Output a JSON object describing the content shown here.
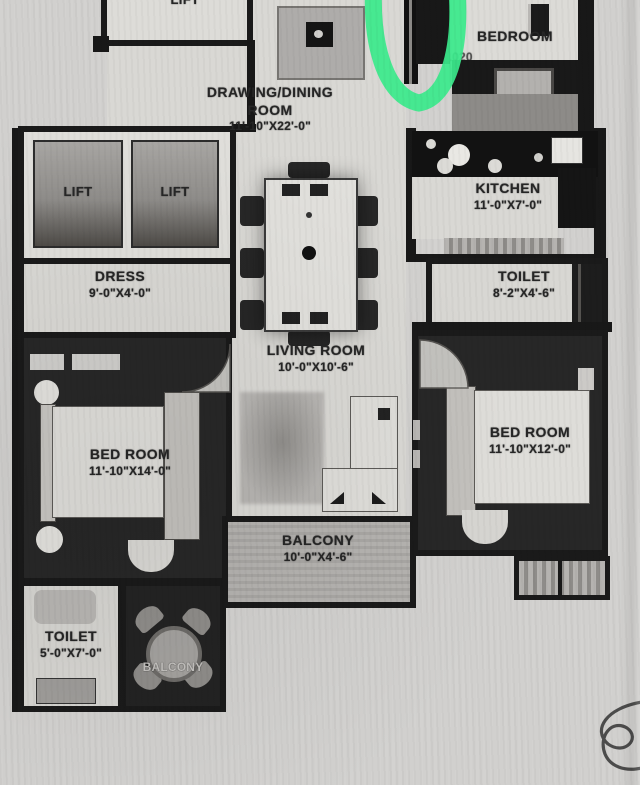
{
  "document": {
    "kind": "Scanned apartment floor plan (black & white photocopy)"
  },
  "rooms": {
    "lift_top": {
      "name": "LIFT"
    },
    "bedroom_top": {
      "name": "BEDROOM",
      "dims": "1020"
    },
    "drawing_dining": {
      "line1": "DRAWING/DINING",
      "line2": "ROOM",
      "dims": "11'-10\"X22'-0\""
    },
    "lift_a": {
      "name": "LIFT"
    },
    "lift_b": {
      "name": "LIFT"
    },
    "kitchen": {
      "name": "KITCHEN",
      "dims": "11'-0\"X7'-0\""
    },
    "dress": {
      "name": "DRESS",
      "dims": "9'-0\"X4'-0\""
    },
    "toilet_right": {
      "name": "TOILET",
      "dims": "8'-2\"X4'-6\""
    },
    "living": {
      "name": "LIVING ROOM",
      "dims": "10'-0\"X10'-6\""
    },
    "bedroom_left": {
      "name": "BED ROOM",
      "dims": "11'-10\"X14'-0\""
    },
    "bedroom_right": {
      "name": "BED ROOM",
      "dims": "11'-10\"X12'-0\""
    },
    "balcony_center": {
      "name": "BALCONY",
      "dims": "10'-0\"X4'-6\""
    },
    "toilet_left": {
      "name": "TOILET",
      "dims": "5'-0\"X7'-0\""
    },
    "balcony_bottom": {
      "name": "BALCONY"
    }
  },
  "annotations": {
    "marker_color": "#3be98c",
    "marker_shape": "green oval highlighter stroke (cut off at top)",
    "signature": "pen squiggle at bottom right (cut off at edge)"
  }
}
